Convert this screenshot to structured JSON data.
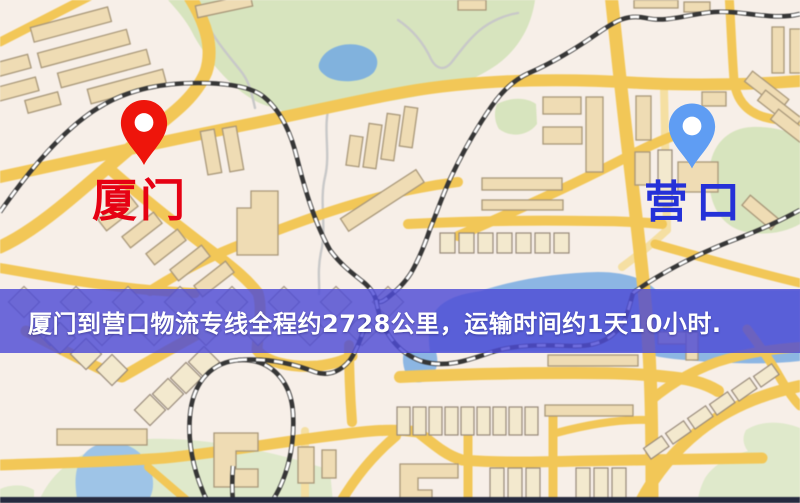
{
  "banner": {
    "text": "厦门到营口物流专线全程约2728公里，运输时间约1天10小时."
  },
  "markers": {
    "origin": {
      "label": "厦门",
      "pin_color": "#ee150b",
      "label_color": "#e60113",
      "icon": "red-map-pin-icon"
    },
    "destination": {
      "label": "营口",
      "pin_color": "#5f9df3",
      "label_color": "#2531d8",
      "icon": "blue-map-pin-icon"
    }
  },
  "palette": {
    "map_background": "#f7efe8",
    "road_yellow": "#f1c75a",
    "building_tan": "#eedcb5",
    "park_green": "#d7e4bf",
    "water_blue": "#8db6e2",
    "railway_dark": "#363636",
    "banner_background": "#4e4cd6",
    "banner_text": "#ffffff",
    "bottom_bar": "#262a3e"
  }
}
